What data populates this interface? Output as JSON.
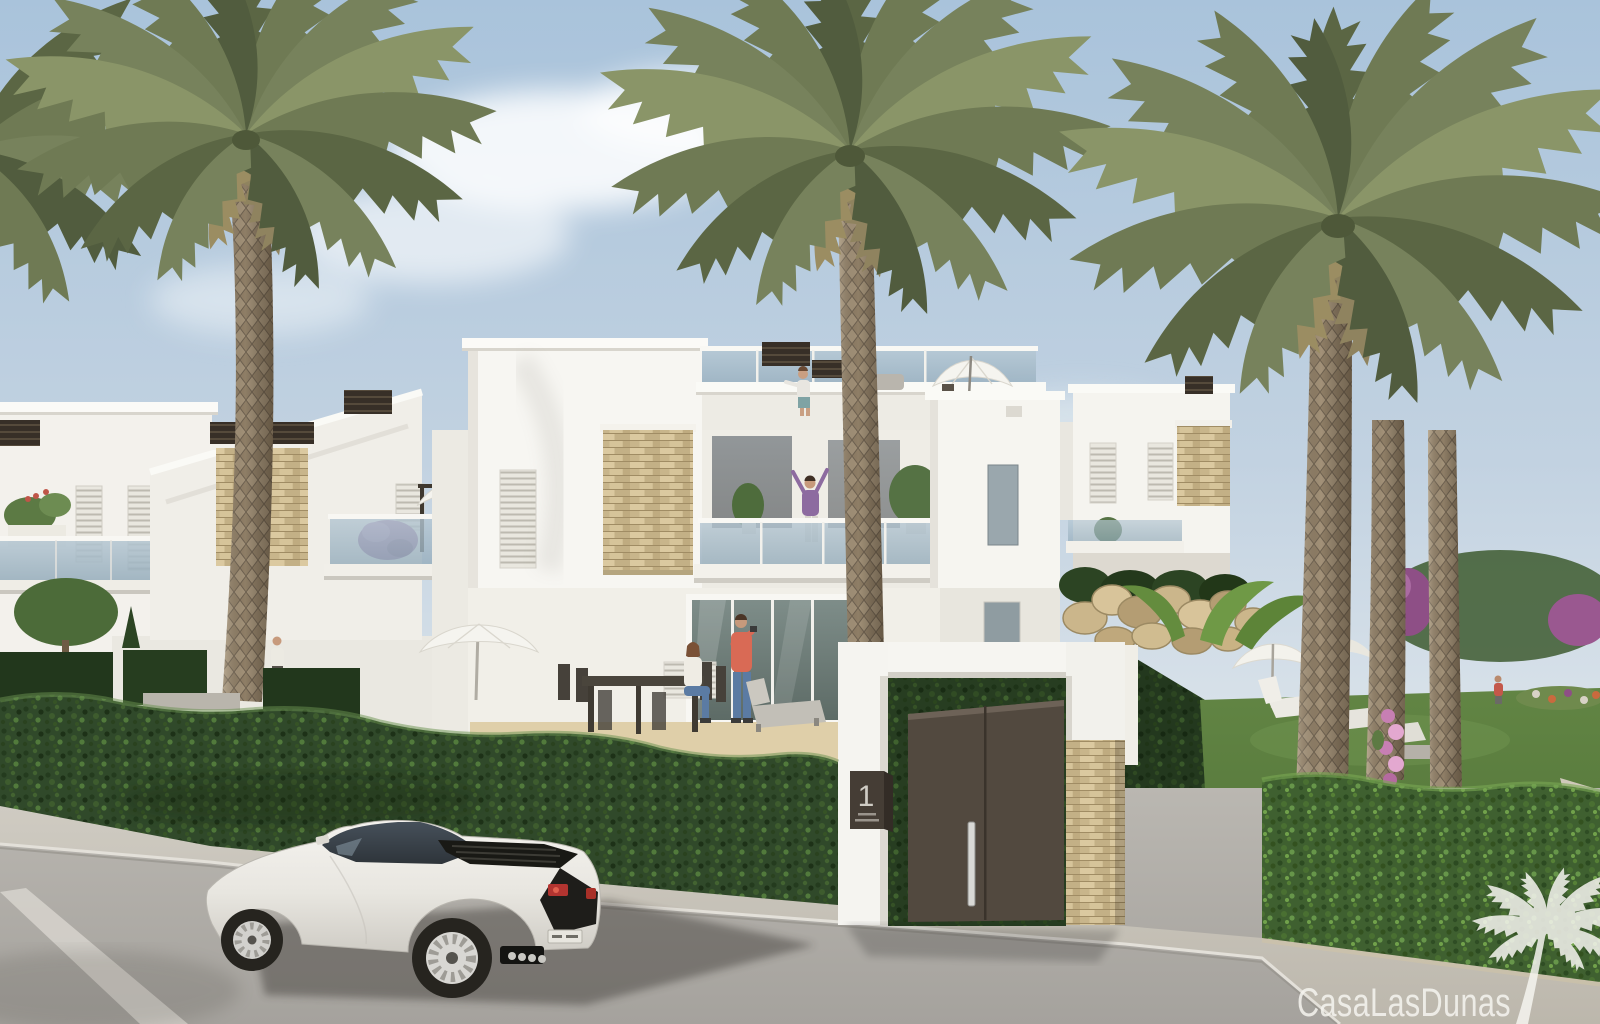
{
  "scene": {
    "type": "exterior-architectural-rendering",
    "subject": "modern white Mediterranean townhouses with palm trees, clipped hedges, entrance gate, garden and a white sports car on the street",
    "lighting": "sunny daylight, soft clouds"
  },
  "watermark": {
    "text": "CasaLasDunas",
    "icon": "palm-tree-icon"
  },
  "gate": {
    "number": "1"
  },
  "palette": {
    "sky_top": "#a9c3db",
    "sky_horizon": "#e7ebee",
    "wall_lit": "#f6f5f1",
    "wall_shaded": "#e6e3dc",
    "stone": "#cfbd93",
    "slat_dark": "#372f27",
    "hedge_base": "#30492a",
    "hedge_bright": "#3f6030",
    "lawn": "#628544",
    "palm_frond": "#6f7a54",
    "palm_trunk": "#a29178",
    "road": "#b0ada7",
    "sidewalk": "#cbc7be",
    "gate_door": "#52493f",
    "plaque": "#453d35",
    "car_body": "#eceae5",
    "glass": "#a3b8c6",
    "watermark_color": "#f6f5f0"
  }
}
